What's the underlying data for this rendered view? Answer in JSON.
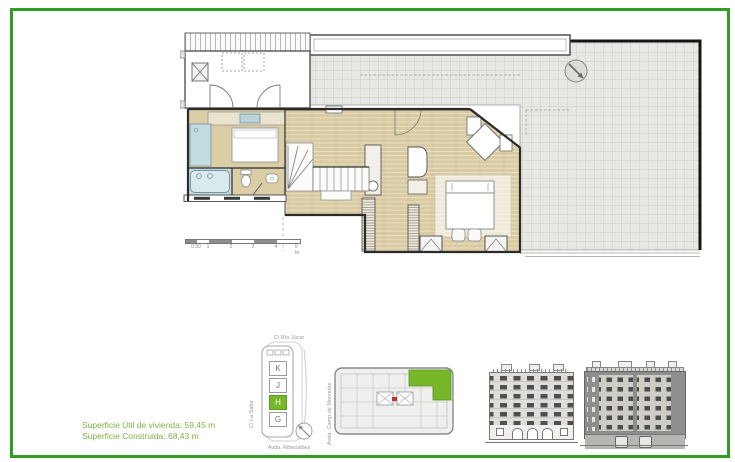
{
  "sheet": {
    "border_color": "#2f9e23",
    "background": "#ffffff",
    "accent_green": "#76b82a"
  },
  "legend": {
    "line1": "Superficie Útil de vivienda: 59,45 m",
    "line2": "Superficie Construida: 68,43 m",
    "color": "#7cb342"
  },
  "site_key": {
    "street_top": "C/ Río Júcar",
    "street_left": "C/ La Safor",
    "street_right": "Avda. Camp de Morvedre",
    "street_bottom": "Avda. Ribesalbes",
    "blocks": [
      {
        "label": "K",
        "highlighted": false
      },
      {
        "label": "J",
        "highlighted": false
      },
      {
        "label": "H",
        "highlighted": true
      },
      {
        "label": "G",
        "highlighted": false
      }
    ]
  },
  "scale_bar": {
    "labels": [
      "0.50",
      "1",
      "2",
      "3",
      "4",
      "5 m"
    ]
  }
}
